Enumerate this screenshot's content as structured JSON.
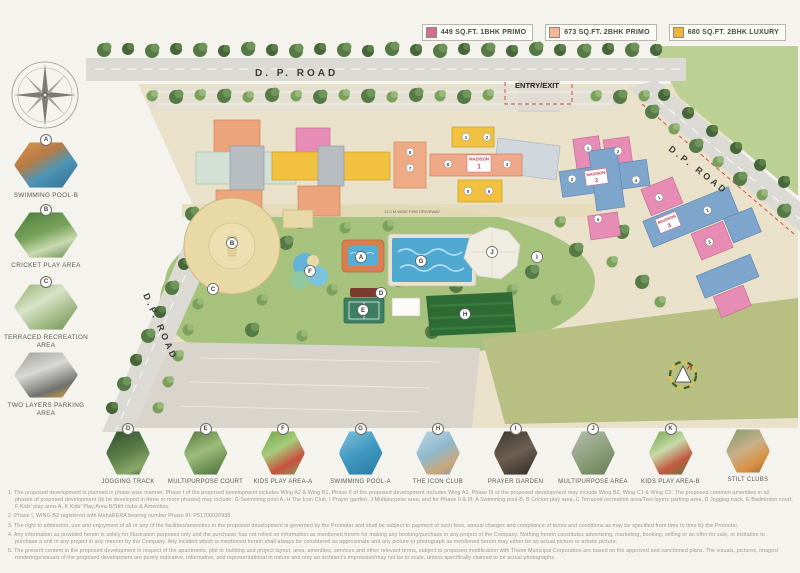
{
  "legend": {
    "items": [
      {
        "label": "449 SQ.FT. 1BHK PRIMO",
        "color": "#d46f93"
      },
      {
        "label": "673 SQ.FT. 2BHK PRIMO",
        "color": "#f2b896"
      },
      {
        "label": "680 SQ.FT. 2BHK LUXURY",
        "color": "#f0b43c"
      }
    ]
  },
  "map": {
    "road_top_label": "D. P. ROAD",
    "road_right_label": "D.P. ROAD",
    "road_left_label": "D.P. ROAD",
    "entry_label": "ENTRY/EXIT",
    "fire_driveway_label": "12.0 M WIDE FIRE DRIVEWAY",
    "buildings": [
      {
        "name": "MADISON",
        "number": "1"
      },
      {
        "name": "MADISON",
        "number": "2"
      },
      {
        "name": "MADISON",
        "number": "3"
      }
    ],
    "wing_numbers": [
      "8",
      "7",
      "1",
      "2",
      "8",
      "3",
      "5",
      "6",
      "1",
      "2",
      "3",
      "4",
      "5",
      "1",
      "2",
      "3"
    ],
    "markers": [
      {
        "letter": "A"
      },
      {
        "letter": "B"
      },
      {
        "letter": "C"
      },
      {
        "letter": "D"
      },
      {
        "letter": "E"
      },
      {
        "letter": "F"
      },
      {
        "letter": "G"
      },
      {
        "letter": "H"
      },
      {
        "letter": "I"
      },
      {
        "letter": "J"
      }
    ]
  },
  "sidebar_amenities": [
    {
      "letter": "A",
      "label": "SWIMMING POOL-B"
    },
    {
      "letter": "B",
      "label": "CRICKET PLAY AREA"
    },
    {
      "letter": "C",
      "label": "TERRACED RECREATION AREA"
    },
    {
      "letter": "",
      "label": "TWO LAYERS PARKING AREA"
    }
  ],
  "bottom_amenities": [
    {
      "letter": "D",
      "label": "JOGGING TRACK"
    },
    {
      "letter": "E",
      "label": "MULTIPURPOSE COURT"
    },
    {
      "letter": "F",
      "label": "KIDS PLAY AREA-A"
    },
    {
      "letter": "G",
      "label": "SWIMMING POOL-A"
    },
    {
      "letter": "H",
      "label": "THE ICON CLUB"
    },
    {
      "letter": "I",
      "label": "PRAYER GARDEN"
    },
    {
      "letter": "J",
      "label": "MULTIPURPOSE AREA"
    },
    {
      "letter": "K",
      "label": "KIDS PLAY AREA-B"
    },
    {
      "letter": "",
      "label": "STILT CLUBS"
    }
  ],
  "disclaimer": {
    "lines": [
      "1. The proposed development is planned in phase wise manner. Phase I of the proposed development includes Wing A2 & Wing B1, Phase II of the proposed development includes Wing A1, Phase III of the proposed development may include Wing B2, Wing C1 & Wing C2. The proposed common amenities in all",
      "phases of proposed development (to be developed in three or more phases) may include: G Swimming pool-A, H The Icon Club, I Prayer garden, J Multipurpose area, and for Phase II & III: A Swimming pool-B, B Cricket play area, C Terraced recreation area/Two layers parking area, D Jogging track, E Badminton court,",
      "F Kids' play area-A, K Kids' Play Area-B/Stilt clubs & Amenities.",
      "2. Phase I, WING B2 registered with MahaRERA bearing number Phase III: P51700020938.",
      "3. The right to admission, use and enjoyment of all or any of the facilities/amenities in the proposed development is governed by the Promoter and shall be subject to payment of such fees, annual charges and compliance of terms and conditions as may be specified from time to time by the Promoter.",
      "4. Any information as provided herein is solely for illustration purposes only and the purchaser has not relied on information as mentioned herein for making any booking/purchase in any project of the Company. Nothing herein constitutes advertising, marketing, booking, selling or an offer for sale, or invitation to",
      "purchase a unit in any project in any manner by the Company. Any incident which is mentioned herein shall always be considered as approximate and any picture or photograph as mentioned herein may either be an actual picture or artistic picture.",
      "5. The present content in the proposed development in respect of the apartments, plot or building and project layout, area, amenities, services and other relevant terms, subject to proposed modification with Thane Municipal Corporation are based on the approved and sanctioned plans. The visuals, pictures, images/",
      "renderings/visuals of the proposed development are purely indicative, informative, and representational in nature and only an architect's impression/may not be to scale, unless specifically claimed to be actual photographs."
    ]
  }
}
